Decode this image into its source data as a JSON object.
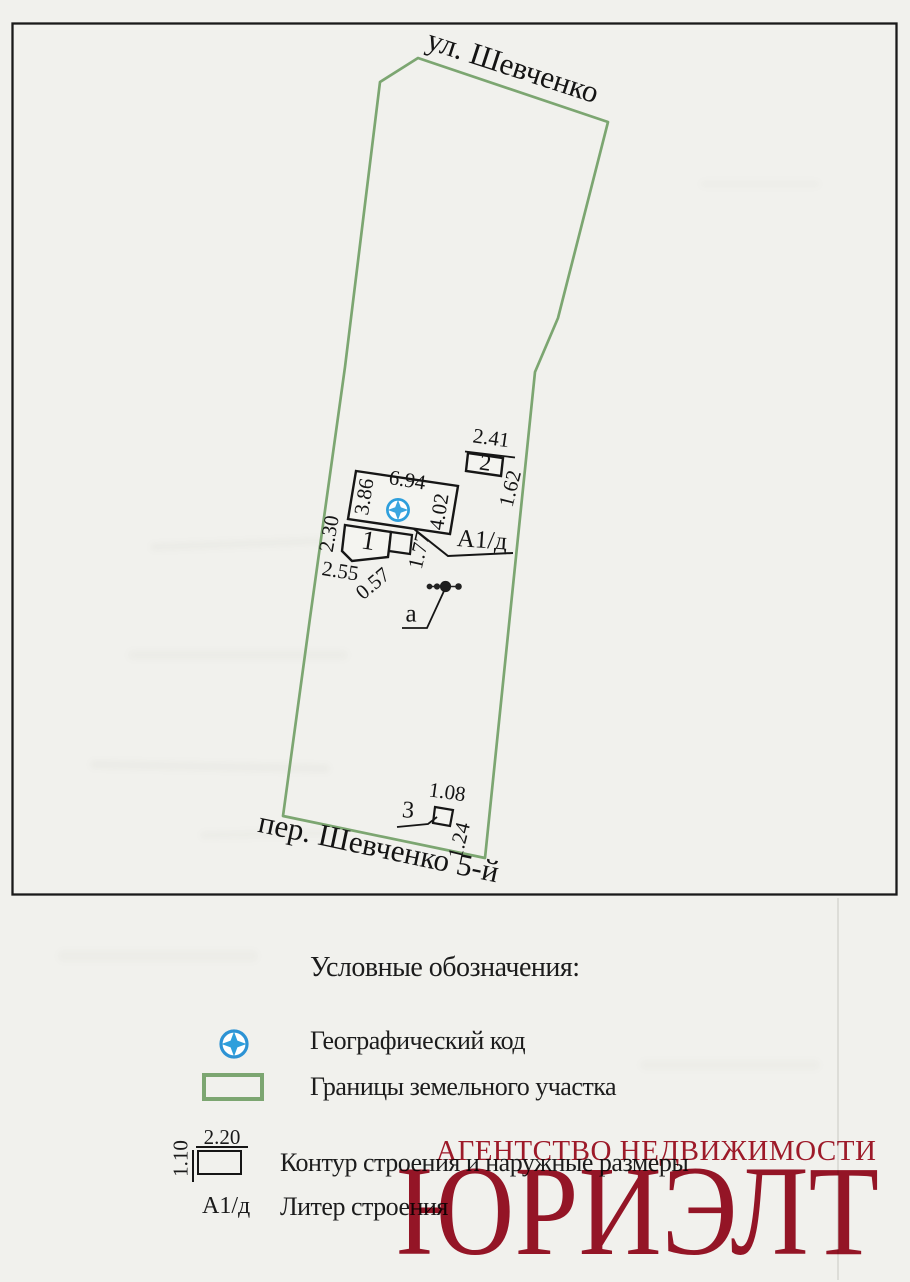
{
  "colors": {
    "boundary_green": "#7ca671",
    "symbol_blue": "#2e9fdc",
    "watermark_red": "#a2182b",
    "ink": "#1a1a1a"
  },
  "plan": {
    "street_top": "ул. Шевченко",
    "street_bottom": "пер. Шевченко 5-й",
    "building1": {
      "number": "1",
      "liter": "А1/д",
      "dims": {
        "top": "6.94",
        "left": "3.86",
        "right": "4.02",
        "wing_left": "2.30",
        "wing_bottom": "2.55",
        "step": "0.57",
        "porch": "1.77"
      }
    },
    "building2": {
      "number": "2",
      "dims": {
        "top": "2.41",
        "right": "1.62"
      }
    },
    "building3": {
      "number": "3",
      "dims": {
        "top": "1.08",
        "right": "1.24"
      }
    },
    "point_a": {
      "label": "а"
    }
  },
  "legend": {
    "title": "Условные обозначения:",
    "items": [
      {
        "label": "Географический код"
      },
      {
        "label": "Границы земельного участка"
      },
      {
        "label": "Контур строения и наружные размеры",
        "dim_top": "2.20",
        "dim_left": "1.10"
      },
      {
        "label": "Литер строения",
        "symbol": "А1/д"
      }
    ]
  },
  "watermark": {
    "line1": "АГЕНТСТВО НЕДВИЖИМОСТИ",
    "line2": "ЮРИЭЛТ"
  }
}
